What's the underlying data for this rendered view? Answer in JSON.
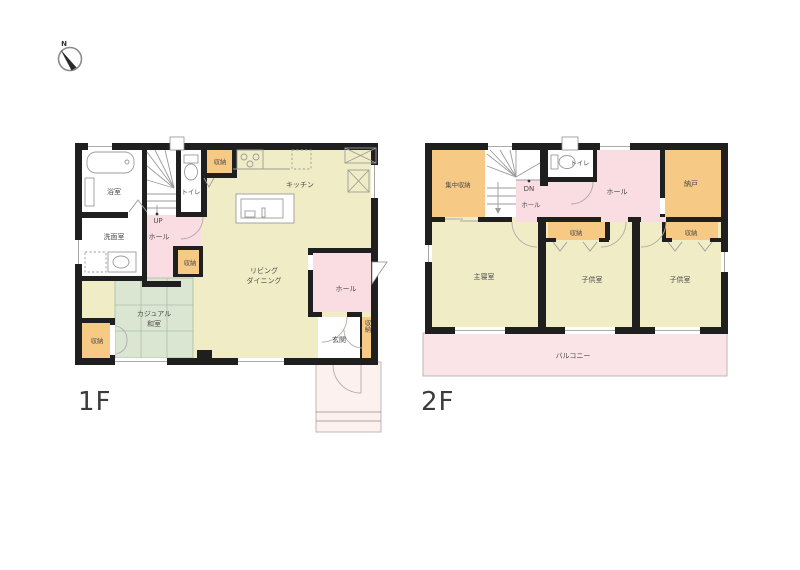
{
  "compass": {
    "north": "N"
  },
  "floor1": {
    "name": "1F",
    "rooms": {
      "bathroom": "浴室",
      "washroom": "洗面室",
      "toilet": "トイレ",
      "stairs": "UP",
      "hall_stairs": "ホール",
      "storage_kitchen": "収納",
      "storage_hall": "収納",
      "kitchen": "キッチン",
      "living_dining_lines": [
        "リビング",
        "ダイニング"
      ],
      "tatami_lines": [
        "カジュアル",
        "和室"
      ],
      "storage_tatami": "収納",
      "hall_entrance": "ホール",
      "entrance": "玄関",
      "storage_entrance": "収納"
    }
  },
  "floor2": {
    "name": "2F",
    "rooms": {
      "central_storage": "集中収納",
      "stairs": "DN",
      "hall_stairs": "ホール",
      "toilet": "トイレ",
      "hall": "ホール",
      "storeroom": "納戸",
      "master_bedroom": "主寝室",
      "storage_child1": "収納",
      "child_room1": "子供室",
      "storage_child2": "収納",
      "child_room2": "子供室",
      "balcony": "バルコニー"
    }
  },
  "colors": {
    "wall": "#1f1f1f",
    "room_yellow": "#f0edc6",
    "room_pink": "#fadde3",
    "room_orange": "#f6c985",
    "tatami_green": "#dae6d2",
    "balcony_pink": "#fbe4e8",
    "porch_pink": "#fdf1ef",
    "label_text": "#4a4a4a"
  }
}
